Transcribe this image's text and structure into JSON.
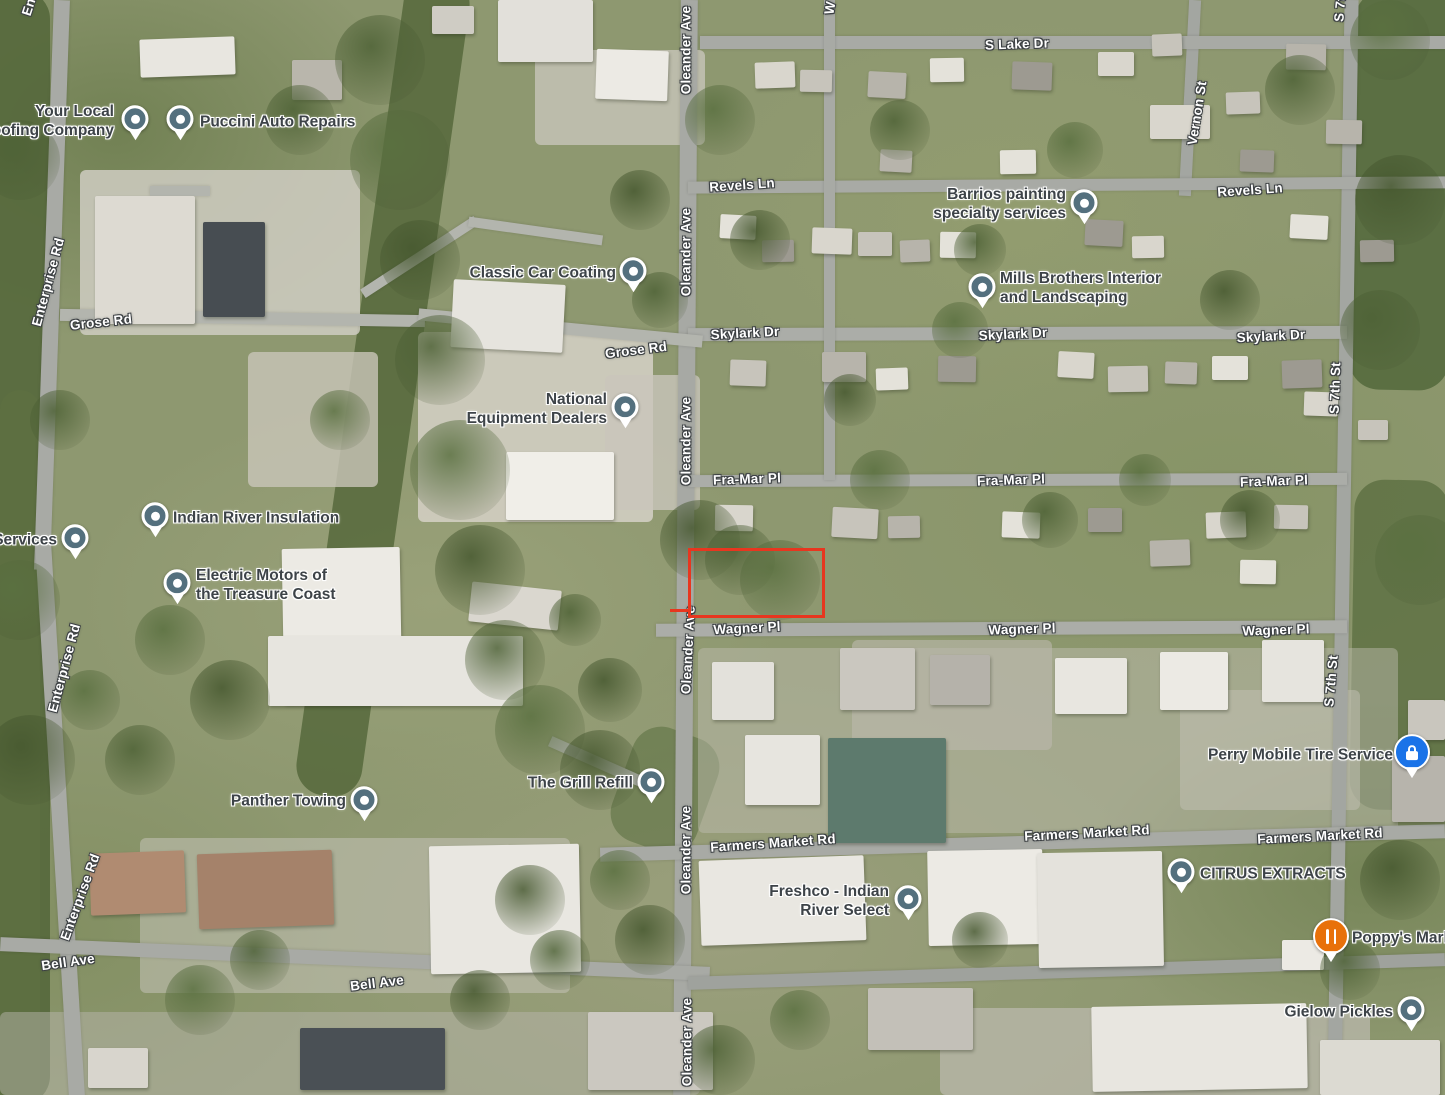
{
  "map": {
    "view": "satellite",
    "colors": {
      "street_text": "#ffffff",
      "street_halo": "#3c4043",
      "business_text": "#3d4348",
      "business_halo": "#ffffff",
      "pin_default": "#54707e",
      "pin_blue": "#1a73e8",
      "pin_orange": "#e8710a",
      "parcel_outline": "#e8361f"
    },
    "streets": [
      {
        "text": "Enterprise Rd",
        "x": 40,
        "y": -28,
        "rot": -72
      },
      {
        "text": "Enterprise Rd",
        "x": 48,
        "y": 282,
        "rot": -75
      },
      {
        "text": "Grose Rd",
        "x": 101,
        "y": 322,
        "rot": -6
      },
      {
        "text": "Enterprise Rd",
        "x": 64,
        "y": 668,
        "rot": -75
      },
      {
        "text": "Enterprise Rd",
        "x": 80,
        "y": 897,
        "rot": -70
      },
      {
        "text": "Bell Ave",
        "x": 68,
        "y": 962,
        "rot": -8
      },
      {
        "text": "Bell Ave",
        "x": 377,
        "y": 983,
        "rot": -7
      },
      {
        "text": "Grose Rd",
        "x": 636,
        "y": 350,
        "rot": -7
      },
      {
        "text": "Oleander Ave",
        "x": 686,
        "y": 50,
        "rot": -90
      },
      {
        "text": "Oleander Ave",
        "x": 686,
        "y": 252,
        "rot": -90
      },
      {
        "text": "Oleander Ave",
        "x": 686,
        "y": 441,
        "rot": -90
      },
      {
        "text": "Oleander Ave",
        "x": 688,
        "y": 650,
        "rot": -87
      },
      {
        "text": "Oleander Ave",
        "x": 686,
        "y": 850,
        "rot": -90
      },
      {
        "text": "Oleander Ave",
        "x": 687,
        "y": 1042,
        "rot": -90
      },
      {
        "text": "W",
        "x": 830,
        "y": 8,
        "rot": -80
      },
      {
        "text": "S Lake Dr",
        "x": 1017,
        "y": 44,
        "rot": -2
      },
      {
        "text": "Revels Ln",
        "x": 742,
        "y": 185,
        "rot": -4
      },
      {
        "text": "Revels Ln",
        "x": 1250,
        "y": 190,
        "rot": -4
      },
      {
        "text": "Vernon St",
        "x": 1197,
        "y": 113,
        "rot": -81
      },
      {
        "text": "Skylark Dr",
        "x": 745,
        "y": 333,
        "rot": -3
      },
      {
        "text": "Skylark Dr",
        "x": 1013,
        "y": 334,
        "rot": -3
      },
      {
        "text": "Skylark Dr",
        "x": 1271,
        "y": 336,
        "rot": -3
      },
      {
        "text": "Fra-Mar Pl",
        "x": 747,
        "y": 479,
        "rot": -2
      },
      {
        "text": "Fra-Mar Pl",
        "x": 1011,
        "y": 480,
        "rot": -2
      },
      {
        "text": "Fra-Mar Pl",
        "x": 1274,
        "y": 481,
        "rot": -2
      },
      {
        "text": "S 7th St",
        "x": 1341,
        "y": -4,
        "rot": -85
      },
      {
        "text": "S 7th St",
        "x": 1335,
        "y": 388,
        "rot": -88
      },
      {
        "text": "S 7th St",
        "x": 1331,
        "y": 681,
        "rot": -85
      },
      {
        "text": "Wagner Pl",
        "x": 747,
        "y": 628,
        "rot": -3
      },
      {
        "text": "Wagner Pl",
        "x": 1022,
        "y": 629,
        "rot": -2
      },
      {
        "text": "Wagner Pl",
        "x": 1276,
        "y": 630,
        "rot": -2
      },
      {
        "text": "Farmers Market Rd",
        "x": 773,
        "y": 843,
        "rot": -4
      },
      {
        "text": "Farmers Market Rd",
        "x": 1087,
        "y": 833,
        "rot": -3
      },
      {
        "text": "Farmers Market Rd",
        "x": 1320,
        "y": 836,
        "rot": -3
      }
    ],
    "businesses": [
      {
        "id": "your-local-roofing-company",
        "lines": [
          "Your Local",
          "Roofing Company"
        ],
        "align": "right",
        "x": 114,
        "y": 121,
        "pin": {
          "x": 135,
          "y": 119,
          "type": "default"
        }
      },
      {
        "id": "puccini-auto-repairs",
        "lines": [
          "Puccini Auto Repairs"
        ],
        "align": "left",
        "x": 200,
        "y": 122,
        "pin": {
          "x": 180,
          "y": 119,
          "type": "default"
        }
      },
      {
        "id": "classic-car-coating",
        "lines": [
          "Classic Car Coating"
        ],
        "align": "right",
        "x": 616,
        "y": 273,
        "pin": {
          "x": 633,
          "y": 271,
          "type": "default"
        }
      },
      {
        "id": "barrios-painting-specialty-services",
        "lines": [
          "Barrios painting",
          "specialty services"
        ],
        "align": "right",
        "x": 1066,
        "y": 204,
        "pin": {
          "x": 1084,
          "y": 203,
          "type": "default"
        }
      },
      {
        "id": "mills-brothers-interior-and-landscaping",
        "lines": [
          "Mills Brothers Interior",
          "and Landscaping"
        ],
        "align": "left",
        "x": 1000,
        "y": 288,
        "pin": {
          "x": 982,
          "y": 287,
          "type": "default"
        }
      },
      {
        "id": "national-equipment-dealers",
        "lines": [
          "National",
          "Equipment Dealers"
        ],
        "align": "right",
        "x": 607,
        "y": 409,
        "pin": {
          "x": 625,
          "y": 407,
          "type": "default"
        }
      },
      {
        "id": "indian-river-insulation",
        "lines": [
          "Indian River Insulation"
        ],
        "align": "left",
        "x": 173,
        "y": 518,
        "pin": {
          "x": 155,
          "y": 516,
          "type": "default"
        }
      },
      {
        "id": "services-partial",
        "lines": [
          "g Services"
        ],
        "align": "right",
        "x": 57,
        "y": 540,
        "pin": {
          "x": 75,
          "y": 538,
          "type": "default"
        }
      },
      {
        "id": "electric-motors-of-the-treasure-coast",
        "lines": [
          "Electric Motors of",
          "the Treasure Coast"
        ],
        "align": "left",
        "x": 196,
        "y": 585,
        "pin": {
          "x": 177,
          "y": 583,
          "type": "default"
        }
      },
      {
        "id": "the-grill-refill",
        "lines": [
          "The Grill Refill"
        ],
        "align": "right",
        "x": 633,
        "y": 783,
        "pin": {
          "x": 651,
          "y": 782,
          "type": "default"
        }
      },
      {
        "id": "panther-towing",
        "lines": [
          "Panther Towing"
        ],
        "align": "right",
        "x": 346,
        "y": 801,
        "pin": {
          "x": 364,
          "y": 800,
          "type": "default"
        }
      },
      {
        "id": "perry-mobile-tire-service",
        "lines": [
          "Perry Mobile Tire Service"
        ],
        "align": "right",
        "x": 1393,
        "y": 755,
        "pin": {
          "x": 1412,
          "y": 752,
          "type": "blue-lock"
        }
      },
      {
        "id": "freshco-indian-river-select",
        "lines": [
          "Freshco - Indian",
          "River Select"
        ],
        "align": "right",
        "x": 889,
        "y": 901,
        "pin": {
          "x": 908,
          "y": 899,
          "type": "default"
        }
      },
      {
        "id": "citrus-extracts",
        "lines": [
          "CITRUS EXTRACTS"
        ],
        "align": "left",
        "x": 1200,
        "y": 874,
        "pin": {
          "x": 1181,
          "y": 872,
          "type": "default"
        }
      },
      {
        "id": "poppys-market",
        "lines": [
          "Poppy's Market"
        ],
        "align": "left",
        "x": 1352,
        "y": 938,
        "pin": {
          "x": 1331,
          "y": 936,
          "type": "orange-restaurant"
        }
      },
      {
        "id": "gielow-pickles",
        "lines": [
          "Gielow Pickles"
        ],
        "align": "right",
        "x": 1393,
        "y": 1012,
        "pin": {
          "x": 1411,
          "y": 1010,
          "type": "default"
        }
      }
    ],
    "parcel_outline": {
      "x": 688,
      "y": 548,
      "w": 131,
      "h": 64,
      "tail": {
        "x": 670,
        "y": 609,
        "w": 20
      }
    }
  }
}
